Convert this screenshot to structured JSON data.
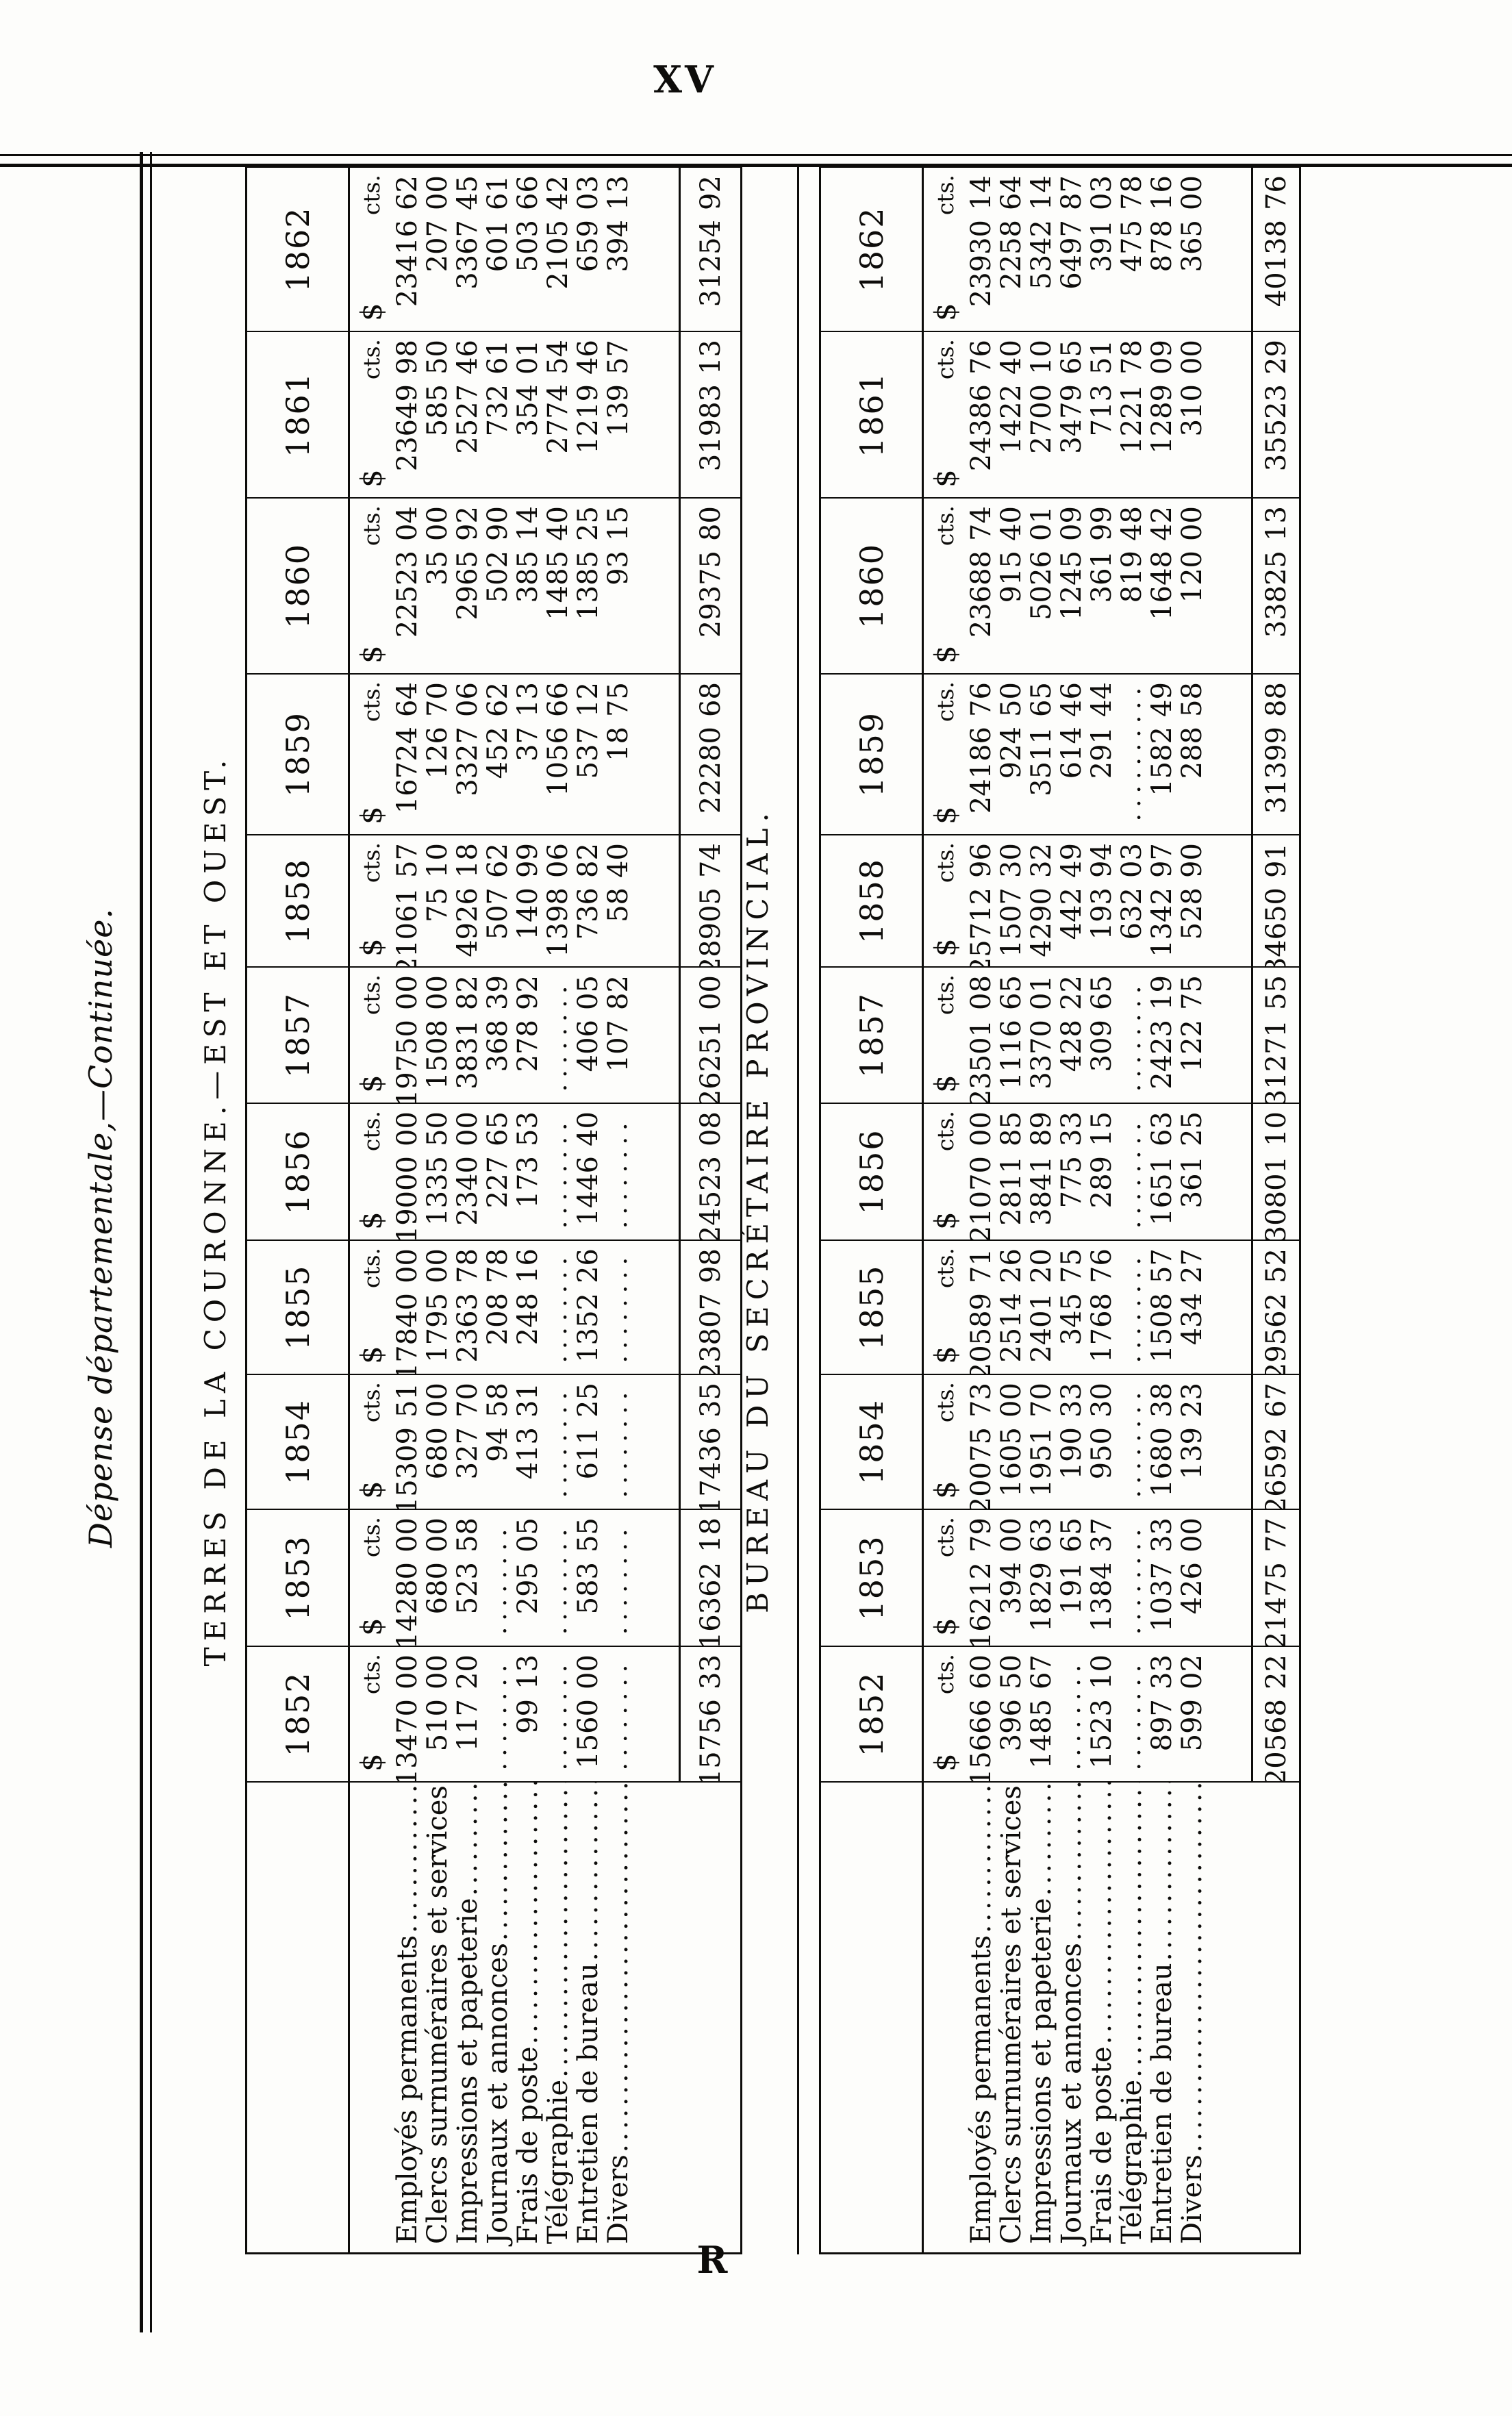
{
  "page": {
    "page_number": "XV",
    "signature_mark": "R",
    "title": "Dépense départementale,—Continuée."
  },
  "currency": {
    "dollar": "$",
    "cents": "cts."
  },
  "tables": [
    {
      "caption": "TERRES DE LA COURONNE.—EST ET OUEST.",
      "years": [
        "1852",
        "1853",
        "1854",
        "1855",
        "1856",
        "1857",
        "1858",
        "1859",
        "1860",
        "1861",
        "1862"
      ],
      "rows": [
        {
          "label": "Employés permanents",
          "values": [
            "13470 00",
            "14280 00",
            "15309 51",
            "17840 00",
            "19000 00",
            "19750 00",
            "21061 57",
            "16724 64",
            "22523 04",
            "23649 98",
            "23416 62"
          ]
        },
        {
          "label": "Clercs surnuméraires et services",
          "values": [
            "510 00",
            "680 00",
            "680 00",
            "1795 00",
            "1335 50",
            "1508 00",
            "75 10",
            "126 70",
            "35 00",
            "585 50",
            "207 00"
          ]
        },
        {
          "label": "Impressions et papeterie",
          "values": [
            "117 20",
            "523 58",
            "327 70",
            "2363 78",
            "2340 00",
            "3831 82",
            "4926 18",
            "3327 06",
            "2965 92",
            "2527 46",
            "3367 45"
          ]
        },
        {
          "label": "Journaux et annonces",
          "values": [
            "",
            "",
            "94 58",
            "208 78",
            "227 65",
            "368 39",
            "507 62",
            "452 62",
            "502 90",
            "732 61",
            "601 61"
          ]
        },
        {
          "label": "Frais de poste",
          "values": [
            "99 13",
            "295 05",
            "413 31",
            "248 16",
            "173 53",
            "278 92",
            "140 99",
            "37 13",
            "385 14",
            "354 01",
            "503 66"
          ]
        },
        {
          "label": "Télégraphie",
          "values": [
            "",
            "",
            "",
            "",
            "",
            "",
            "1398 06",
            "1056 66",
            "1485 40",
            "2774 54",
            "2105 42"
          ]
        },
        {
          "label": "Entretien de bureau",
          "values": [
            "1560 00",
            "583 55",
            "611 25",
            "1352 26",
            "1446 40",
            "406 05",
            "736 82",
            "537 12",
            "1385 25",
            "1219 46",
            "659 03"
          ]
        },
        {
          "label": "Divers",
          "values": [
            "",
            "",
            "",
            "",
            "",
            "107 82",
            "58 40",
            "18 75",
            "93 15",
            "139 57",
            "394 13"
          ]
        }
      ],
      "totals": [
        "15756 33",
        "16362 18",
        "17436 35",
        "23807 98",
        "24523 08",
        "26251 00",
        "28905 74",
        "22280 68",
        "29375 80",
        "31983 13",
        "31254 92"
      ]
    },
    {
      "caption": "BUREAU DU SECRÉTAIRE PROVINCIAL.",
      "years": [
        "1852",
        "1853",
        "1854",
        "1855",
        "1856",
        "1857",
        "1858",
        "1859",
        "1860",
        "1861",
        "1862"
      ],
      "rows": [
        {
          "label": "Employés permanents",
          "values": [
            "15666 60",
            "16212 79",
            "20075 73",
            "20589 71",
            "21070 00",
            "23501 08",
            "25712 96",
            "24186 76",
            "23688 74",
            "24386 76",
            "23930 14"
          ]
        },
        {
          "label": "Clercs surnuméraires et services",
          "values": [
            "396 50",
            "394 00",
            "1605 00",
            "2514 26",
            "2811 85",
            "1116 65",
            "1507 30",
            "924 50",
            "915 40",
            "1422 40",
            "2258 64"
          ]
        },
        {
          "label": "Impressions et papeterie",
          "values": [
            "1485 67",
            "1829 63",
            "1951 70",
            "2401 20",
            "3841 89",
            "3370 01",
            "4290 32",
            "3511 65",
            "5026 01",
            "2700 10",
            "5342 14"
          ]
        },
        {
          "label": "Journaux et annonces",
          "values": [
            "",
            "191 65",
            "190 33",
            "345 75",
            "775 33",
            "428 22",
            "442 49",
            "614 46",
            "1245 09",
            "3479 65",
            "6497 87"
          ]
        },
        {
          "label": "Frais de poste",
          "values": [
            "1523 10",
            "1384 37",
            "950 30",
            "1768 76",
            "289 15",
            "309 65",
            "193 94",
            "291 44",
            "361 99",
            "713 51",
            "391 03"
          ]
        },
        {
          "label": "Télégraphie",
          "values": [
            "",
            "",
            "",
            "",
            "",
            "",
            "632 03",
            "",
            "819 48",
            "1221 78",
            "475 78"
          ]
        },
        {
          "label": "Entretien de bureau",
          "values": [
            "897 33",
            "1037 33",
            "1680 38",
            "1508 57",
            "1651 63",
            "2423 19",
            "1342 97",
            "1582 49",
            "1648 42",
            "1289 09",
            "878 16"
          ]
        },
        {
          "label": "Divers",
          "values": [
            "599 02",
            "426 00",
            "139 23",
            "434 27",
            "361 25",
            "122 75",
            "528 90",
            "288 58",
            "120 00",
            "310 00",
            "365 00"
          ]
        }
      ],
      "totals": [
        "20568 22",
        "21475 77",
        "26592 67",
        "29562 52",
        "30801 10",
        "31271 55",
        "34650 91",
        "31399 88",
        "33825 13",
        "35523 29",
        "40138 76"
      ]
    }
  ]
}
